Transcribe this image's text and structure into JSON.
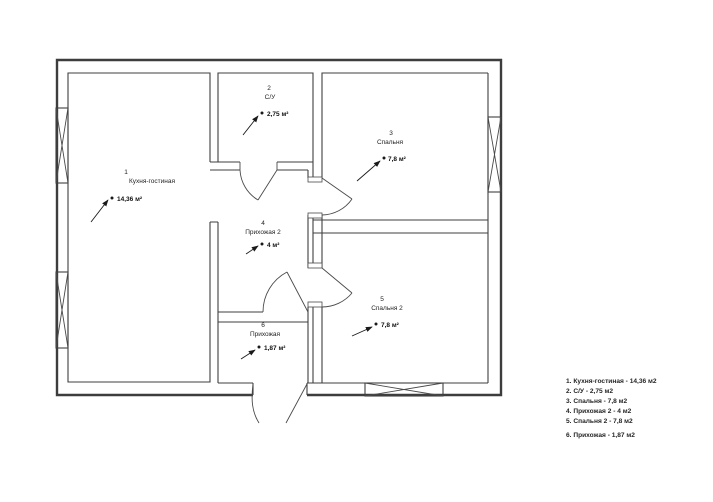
{
  "plan": {
    "rooms": [
      {
        "number": "1",
        "name": "Кухня-гостиная",
        "area": "14,36 м²"
      },
      {
        "number": "2",
        "name": "С/У",
        "area": "2,75 м²"
      },
      {
        "number": "3",
        "name": "Спальня",
        "area": "7,8 м²"
      },
      {
        "number": "4",
        "name": "Прихожая 2",
        "area": "4 м²"
      },
      {
        "number": "5",
        "name": "Спальня 2",
        "area": "7,8 м²"
      },
      {
        "number": "6",
        "name": "Прихожая",
        "area": "1,87 м²"
      }
    ]
  },
  "legend": {
    "items": [
      "1. Кухня-гостиная - 14,36 м2",
      "2. С/У - 2,75 м2",
      "3. Спальня - 7,8 м2",
      "4. Прихожая 2 - 4 м2",
      "5. Спальня 2 - 7,8 м2",
      "6. Прихожая - 1,87 м2"
    ]
  },
  "colors": {
    "wall": "#3d3d3d",
    "text": "#1f1f1f",
    "background": "#ffffff"
  }
}
